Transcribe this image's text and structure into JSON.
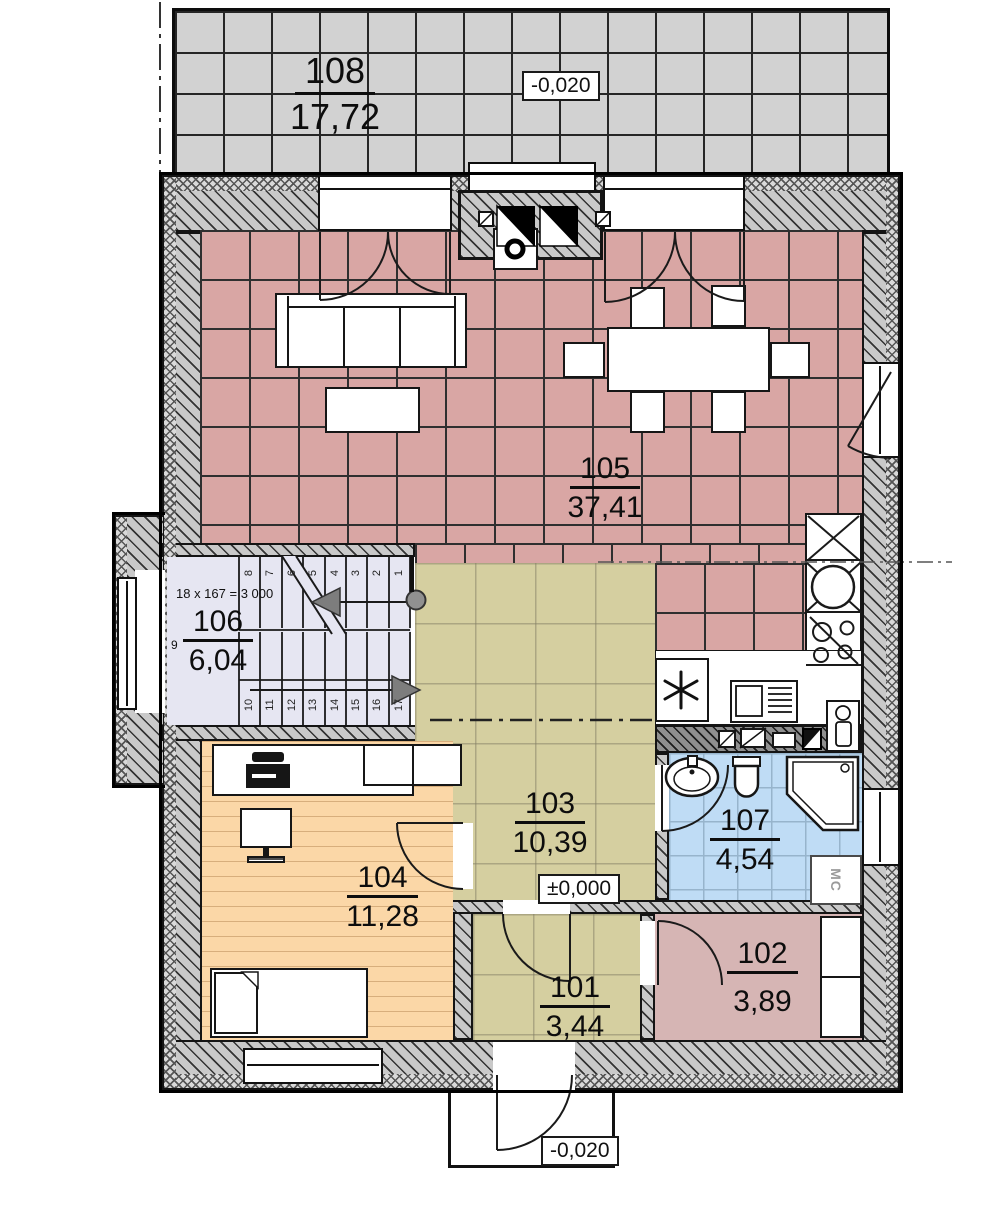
{
  "plan": {
    "rooms": {
      "r101": {
        "number": "101",
        "area": "3,44"
      },
      "r102": {
        "number": "102",
        "area": "3,89"
      },
      "r103": {
        "number": "103",
        "area": "10,39"
      },
      "r104": {
        "number": "104",
        "area": "11,28"
      },
      "r105": {
        "number": "105",
        "area": "37,41"
      },
      "r106": {
        "number": "106",
        "area": "6,04"
      },
      "r107": {
        "number": "107",
        "area": "4,54"
      },
      "r108": {
        "number": "108",
        "area": "17,72"
      }
    },
    "elevations": {
      "terrace": "-0,020",
      "hall": "±0,000",
      "porch": "-0,020"
    },
    "stairs": {
      "formula": "18 x 167 = 3 000",
      "middle_step": "9",
      "top_steps": [
        "8",
        "7",
        "6",
        "5",
        "4",
        "3",
        "2",
        "1"
      ],
      "bottom_steps": [
        "10",
        "11",
        "12",
        "13",
        "14",
        "15",
        "16",
        "17"
      ]
    },
    "labels": {
      "washing_machine": "МС"
    }
  }
}
